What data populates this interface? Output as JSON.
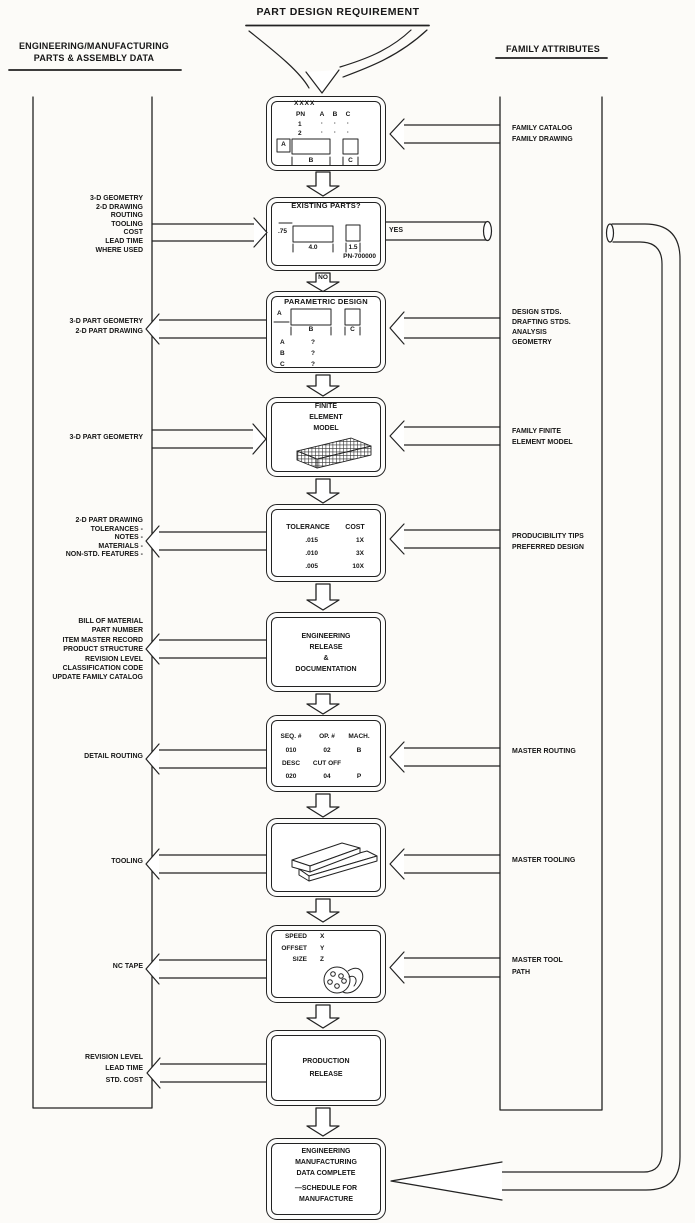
{
  "diagram": {
    "title": "PART DESIGN REQUIREMENT",
    "left_header": [
      "ENGINEERING/MANUFACTURING",
      "PARTS & ASSEMBLY DATA"
    ],
    "right_header": "FAMILY ATTRIBUTES",
    "branch_labels": {
      "yes": "YES",
      "no": "NO"
    }
  },
  "left_labels": [
    {
      "lines": [
        "3-D GEOMETRY",
        "2-D DRAWING",
        "ROUTING",
        "TOOLING",
        "COST",
        "LEAD TIME",
        "WHERE USED"
      ]
    },
    {
      "lines": [
        "3-D PART GEOMETRY",
        "2-D PART DRAWING"
      ]
    },
    {
      "lines": [
        "3-D PART GEOMETRY"
      ]
    },
    {
      "lines": [
        "2-D PART DRAWING",
        "TOLERANCES -",
        "NOTES -",
        "MATERIALS -",
        "NON-STD. FEATURES -"
      ]
    },
    {
      "lines": [
        "BILL OF MATERIAL",
        "PART NUMBER",
        "ITEM MASTER RECORD",
        "PRODUCT STRUCTURE",
        "REVISION LEVEL",
        "CLASSIFICATION CODE",
        "UPDATE FAMILY CATALOG"
      ]
    },
    {
      "lines": [
        "DETAIL ROUTING"
      ]
    },
    {
      "lines": [
        "TOOLING"
      ]
    },
    {
      "lines": [
        "NC TAPE"
      ]
    },
    {
      "lines": [
        "REVISION LEVEL",
        "LEAD TIME",
        "STD. COST"
      ]
    }
  ],
  "right_labels": [
    {
      "lines": [
        "FAMILY CATALOG",
        "FAMILY DRAWING"
      ]
    },
    {
      "lines": [
        "DESIGN STDS.",
        "DRAFTING STDS.",
        "ANALYSIS",
        "GEOMETRY"
      ]
    },
    {
      "lines": [
        "FAMILY FINITE",
        "ELEMENT MODEL"
      ]
    },
    {
      "lines": [
        "PRODUCIBILITY TIPS",
        "PREFERRED DESIGN"
      ]
    },
    {
      "lines": [
        "MASTER ROUTING"
      ]
    },
    {
      "lines": [
        "MASTER TOOLING"
      ]
    },
    {
      "lines": [
        "MASTER TOOL",
        "PATH"
      ]
    }
  ],
  "screens": {
    "catalog": {
      "code": "XXXX",
      "col_headers": [
        "PN",
        "A",
        "B",
        "C"
      ],
      "rows": [
        [
          "1",
          "·",
          "·",
          "·"
        ],
        [
          "2",
          "·",
          "·",
          "·"
        ]
      ],
      "dim_labels": [
        "A",
        "B",
        "C"
      ]
    },
    "existing": {
      "title": "EXISTING PARTS?",
      "dims": [
        ".75",
        "4.0",
        "1.5"
      ],
      "part_number": "PN-700000"
    },
    "parametric": {
      "title": "PARAMETRIC  DESIGN",
      "dim_labels": [
        "A",
        "B",
        "C"
      ],
      "params": [
        [
          "A",
          "?"
        ],
        [
          "B",
          "?"
        ],
        [
          "C",
          "?"
        ]
      ]
    },
    "fem": {
      "lines": [
        "FINITE",
        "ELEMENT",
        "MODEL"
      ]
    },
    "tolerance": {
      "headers": [
        "TOLERANCE",
        "COST"
      ],
      "rows": [
        [
          ".015",
          "1X"
        ],
        [
          ".010",
          "3X"
        ],
        [
          ".005",
          "10X"
        ]
      ]
    },
    "eng_release": {
      "lines": [
        "ENGINEERING",
        "RELEASE",
        "&",
        "DOCUMENTATION"
      ]
    },
    "routing": {
      "headers": [
        "SEQ. #",
        "OP. #",
        "MACH."
      ],
      "rows": [
        [
          "010",
          "02",
          "B"
        ],
        [
          "DESC",
          "CUT OFF",
          ""
        ],
        [
          "020",
          "04",
          "P"
        ]
      ]
    },
    "nc_tape": {
      "rows": [
        [
          "SPEED",
          "X"
        ],
        [
          "OFFSET",
          "Y"
        ],
        [
          "SIZE",
          "Z"
        ]
      ]
    },
    "production": {
      "lines": [
        "PRODUCTION",
        "RELEASE"
      ]
    },
    "complete": {
      "lines": [
        "ENGINEERING",
        "MANUFACTURING",
        "DATA COMPLETE",
        "—SCHEDULE FOR",
        "MANUFACTURE"
      ]
    }
  },
  "colors": {
    "ink": "#222222",
    "paper": "#fcfbf8"
  }
}
